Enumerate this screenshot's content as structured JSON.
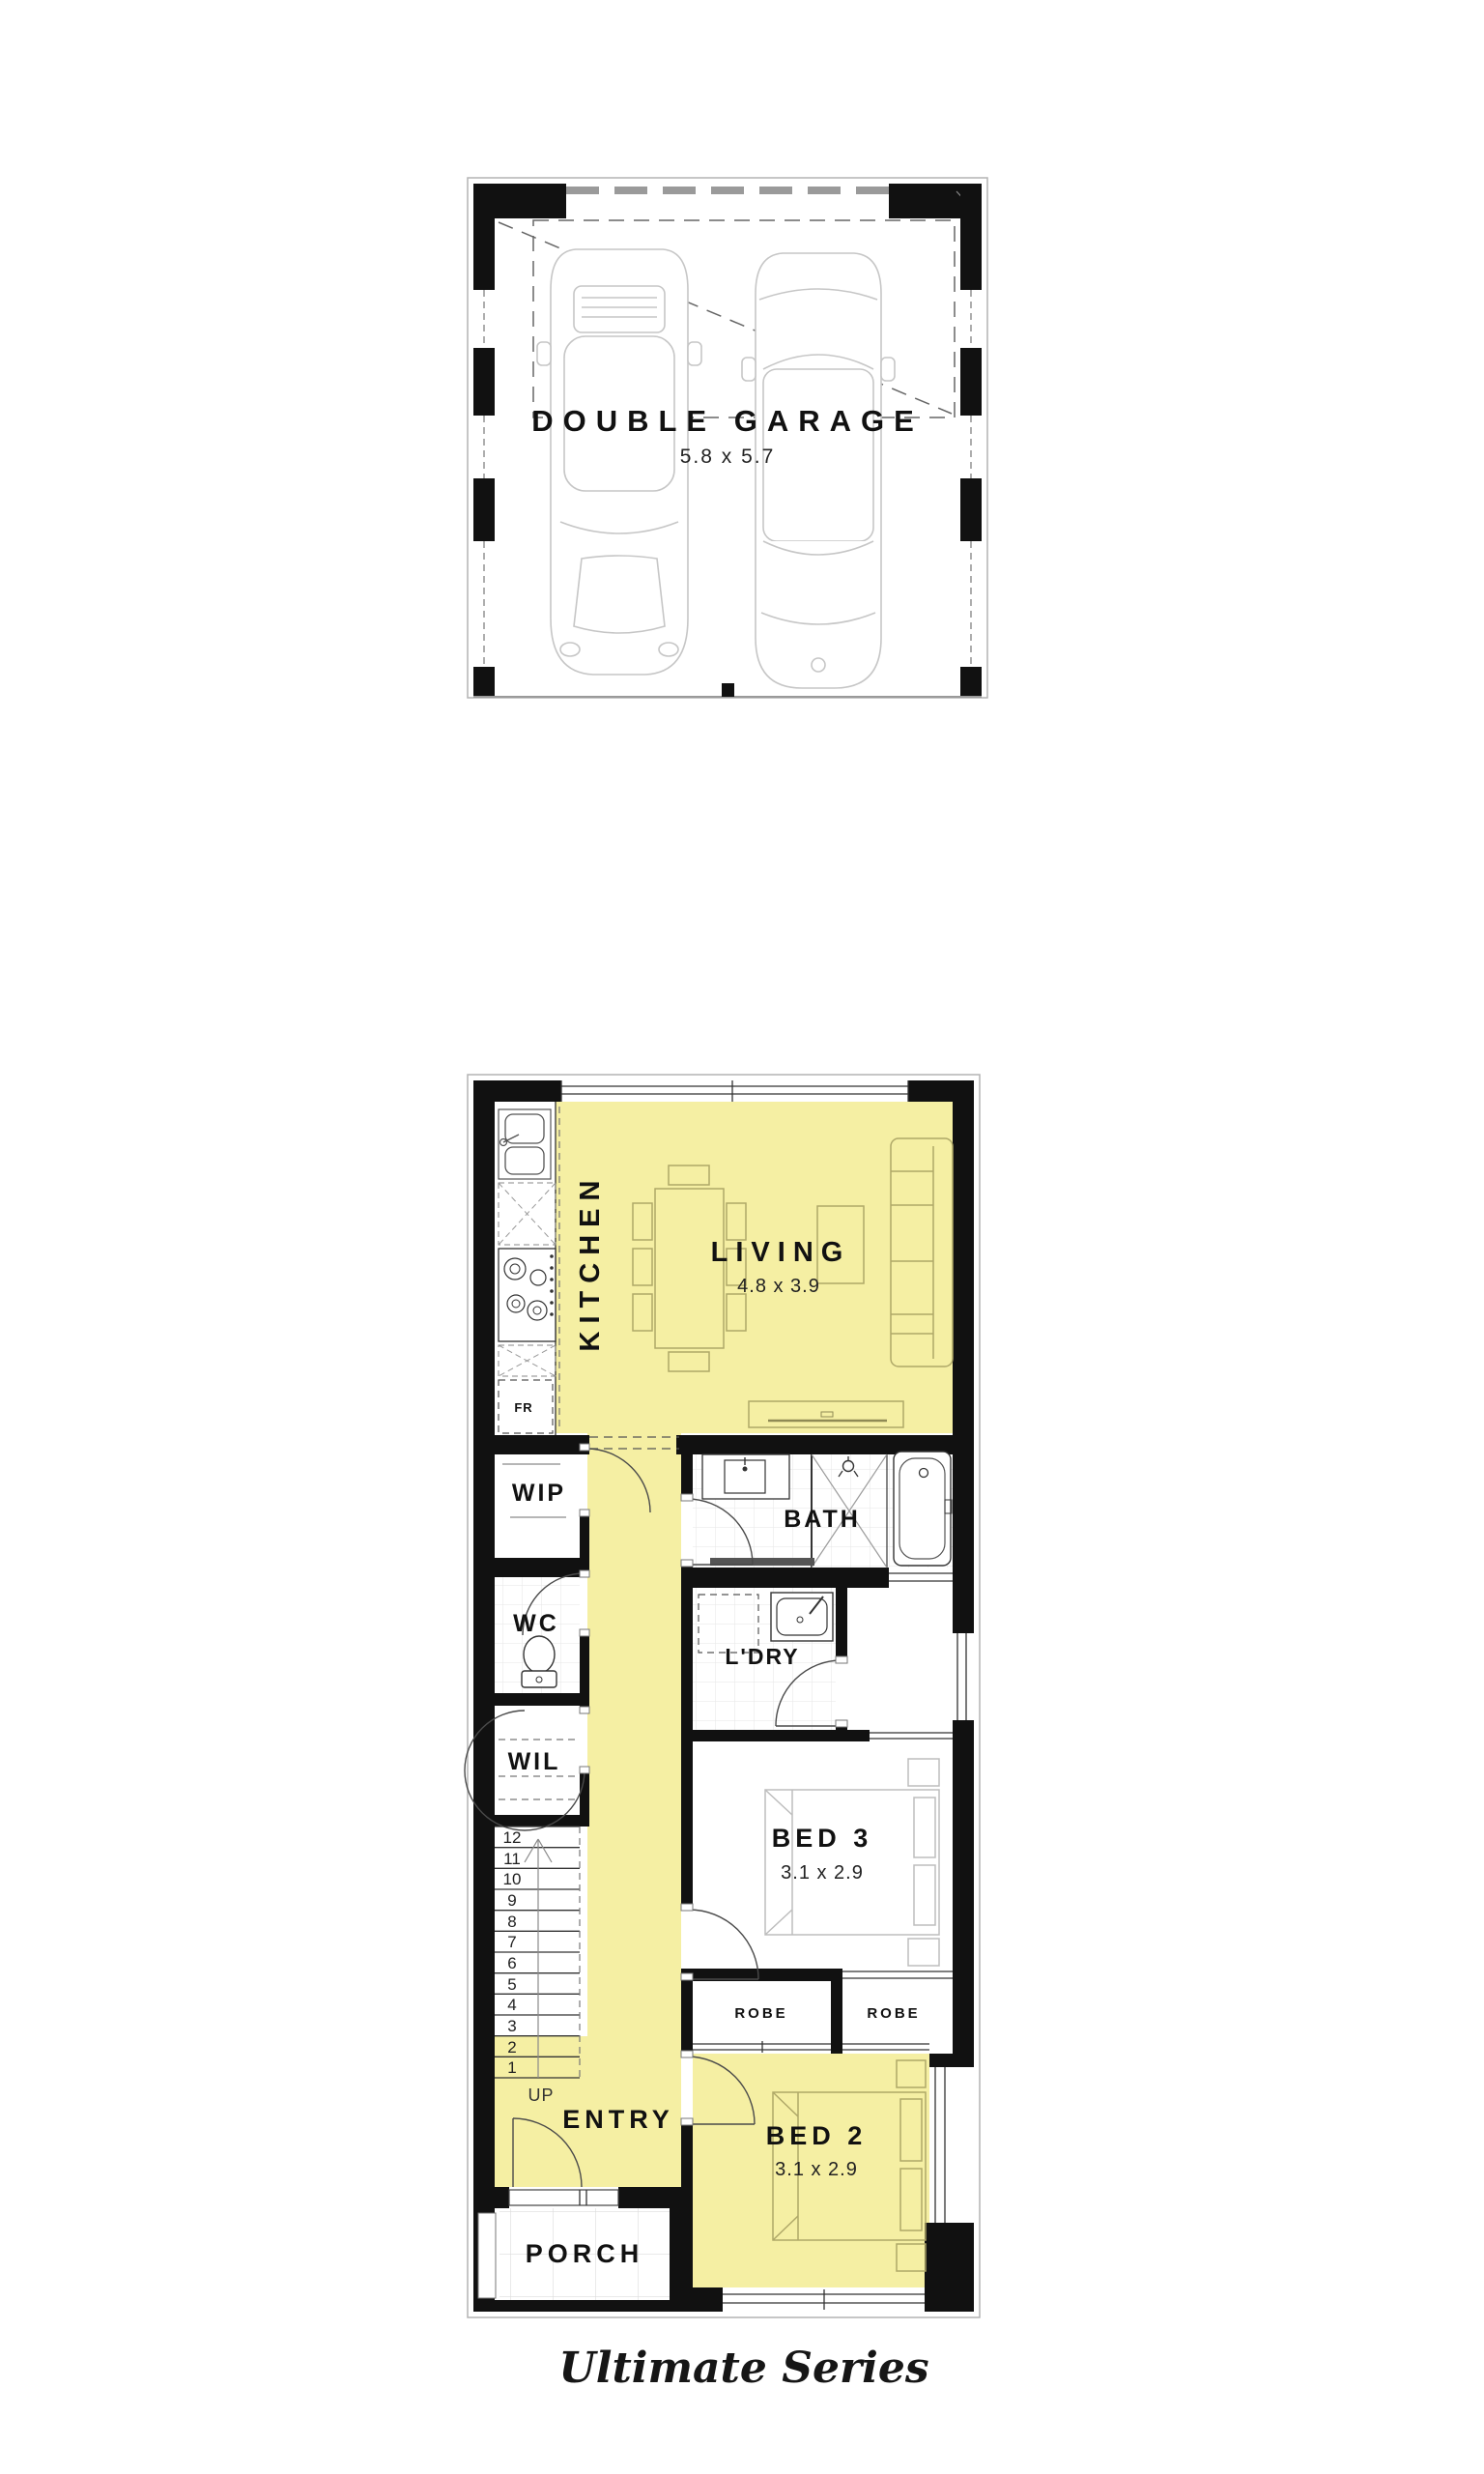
{
  "branding": {
    "series": "Ultimate Series"
  },
  "garage": {
    "label": "DOUBLE GARAGE",
    "dims": "5.8 x 5.7"
  },
  "rooms": {
    "living": {
      "label": "LIVING",
      "dims": "4.8 x 3.9"
    },
    "kitchen": {
      "label": "KITCHEN"
    },
    "fridge": {
      "label": "FR"
    },
    "wip": {
      "label": "WIP"
    },
    "wc": {
      "label": "WC"
    },
    "wil": {
      "label": "WIL"
    },
    "bath": {
      "label": "BATH"
    },
    "ldry": {
      "label": "L'DRY"
    },
    "bed3": {
      "label": "BED 3",
      "dims": "3.1 x 2.9"
    },
    "robe_left": {
      "label": "ROBE"
    },
    "robe_right": {
      "label": "ROBE"
    },
    "bed2": {
      "label": "BED 2",
      "dims": "3.1 x 2.9"
    },
    "entry": {
      "label": "ENTRY"
    },
    "porch": {
      "label": "PORCH"
    }
  },
  "stairs": {
    "up_label": "UP",
    "treads": [
      "12",
      "11",
      "10",
      "9",
      "8",
      "7",
      "6",
      "5",
      "4",
      "3",
      "2",
      "1"
    ]
  },
  "colors": {
    "highlight": "#F5EFA3",
    "wall": "#111111",
    "furniture_line": "#BDBDBD"
  }
}
